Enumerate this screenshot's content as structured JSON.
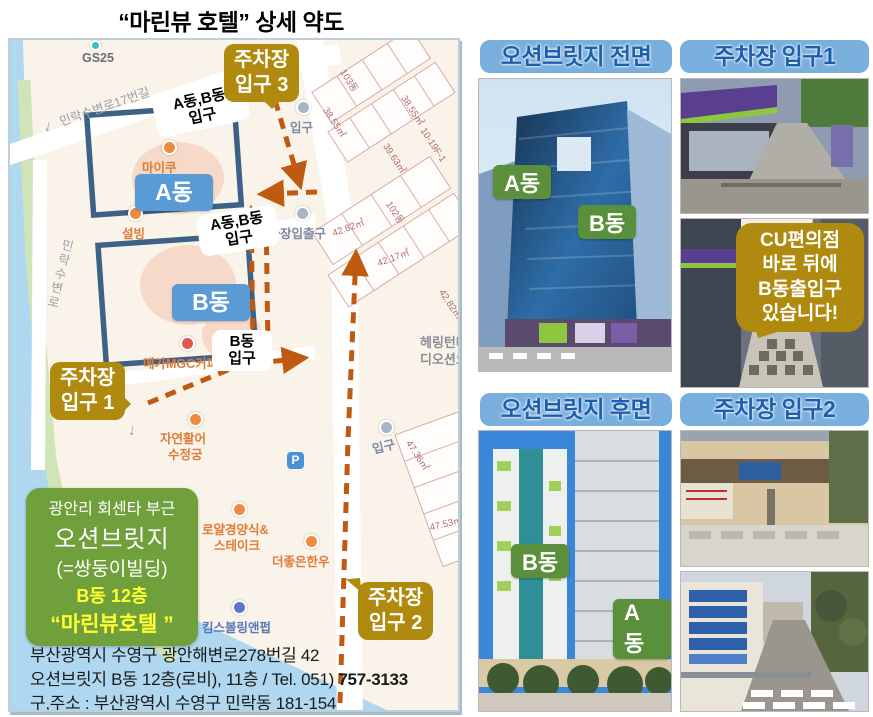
{
  "title": "“마린뷰 호텔” 상세 약도",
  "colors": {
    "accent_gold": "#B08A0E",
    "accent_blue": "#5B9BD5",
    "header_blue": "#79AFDD",
    "header_text": "#1D5FAE",
    "green_box": "#6FA03C",
    "label_green": "#5A8F3C",
    "route": "#C05A11"
  },
  "icons": {
    "one_way_down": "↓",
    "parking_p": "P"
  },
  "map": {
    "roads": {
      "r17": "민락수변로17번길",
      "waterfront": "민락수변로"
    },
    "poi": {
      "gs25": "GS25",
      "maiku": "마이쿠",
      "sulbing": "설빙",
      "mega": "메가MGC커피",
      "fish1": "자연활어",
      "fish2": "수정궁",
      "royal1": "로얄경양식&",
      "royal2": "스테이크",
      "hanwoo": "더좋은한우",
      "bowling": "킴스볼링앤펍",
      "pk_inout": "주차장입출구",
      "ent_top": "입구",
      "ent_bottom": "입구",
      "herrington1": "헤링턴타워",
      "herrington2": "디오션오피"
    },
    "plots": {
      "d103": "103동",
      "a1": "38.55㎡",
      "a2": "38.55㎡",
      "a3": "39.63㎡",
      "a4": "10-19F-1",
      "b1": "42.82㎡",
      "d102": "102동",
      "b2": "42.17㎡",
      "b3": "42.82㎡",
      "c1": "47.36㎡",
      "c2": "47.53㎡"
    },
    "buildings": {
      "a": "A동",
      "b": "B동"
    },
    "entrances": {
      "top1": "A동,B동",
      "top2": "입구",
      "mid1": "A동,B동",
      "mid2": "입구",
      "b1": "B동",
      "b2": "입구"
    },
    "parking": {
      "p3a": "주차장",
      "p3b": "입구 3",
      "p1a": "주차장",
      "p1b": "입구 1",
      "p2a": "주차장",
      "p2b": "입구 2"
    },
    "info": {
      "l1": "광안리 회센타 부근",
      "l2": "오션브릿지",
      "l3": "(=쌍둥이빌딩)",
      "l4": "B동 12층",
      "l5": "“마린뷰호텔 ”"
    },
    "address": {
      "l1": "부산광역시 수영구 광안해변로278번길 42",
      "l2a": "오션브릿지 B동 12층(로비), 11층 / Tel. 051) ",
      "l2b": "757-3133",
      "l3": "구,주소 : 부산광역시 수영구 민락동 181-154"
    }
  },
  "panels": {
    "front": {
      "header": "오션브릿지 전면",
      "label_a": "A동",
      "label_b": "B동"
    },
    "p1": {
      "header": "주차장 입구1",
      "bubble1": "CU편의점",
      "bubble2": "바로 뒤에",
      "bubble3": "B동출입구",
      "bubble4": "있습니다!"
    },
    "rear": {
      "header": "오션브릿지 후면",
      "label_b": "B동",
      "label_a": "A동"
    },
    "p2": {
      "header": "주차장 입구2"
    }
  }
}
